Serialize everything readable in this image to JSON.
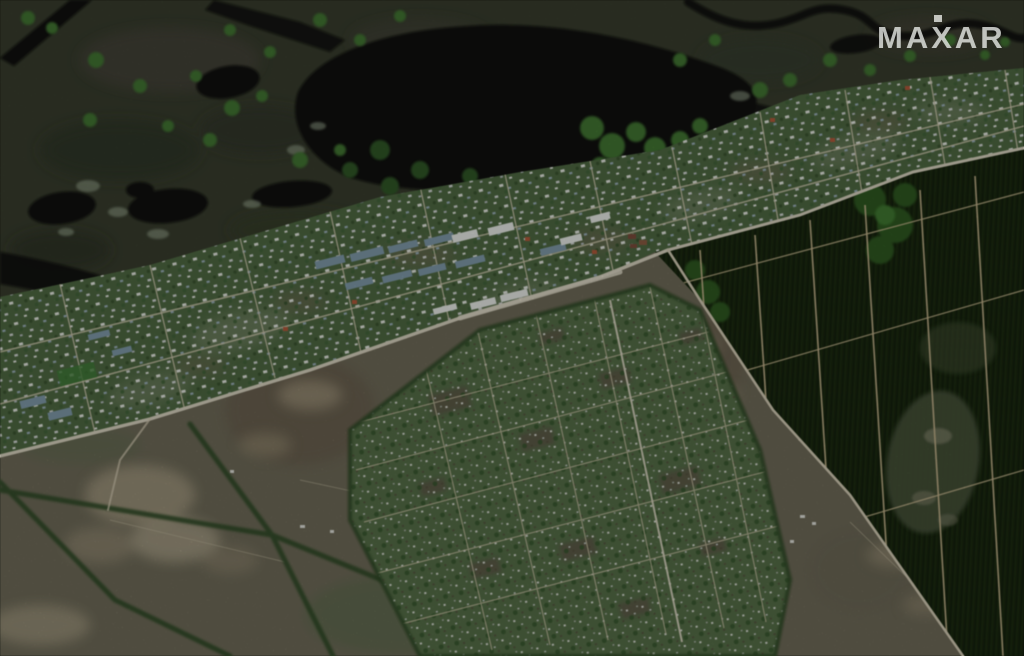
{
  "meta": {
    "type": "satellite-photo",
    "description": "Maxar satellite view: dark marsh wetland with black oxbow lake and winding channels across the top; a diagonal village strip of small houses, barns and light dirt streets; dense pine plantation forest with tan firebreak grid on the right; dacha allotment grid with tiny plots in the center-bottom; open grey-brown farm fields with pale patches and dark hedgerows in the bottom-left."
  },
  "watermark": {
    "text": "MAXAR",
    "color": "#eef0ec",
    "opacity": "0.78"
  },
  "palette": {
    "wetland": "#363b2d",
    "water": "#0a0d08",
    "village": "#4d6842",
    "forest": "#18260f",
    "field": "#6e6a59",
    "dacha": "#57704a",
    "road": "#dcd6c4",
    "street": "#cfc8b0",
    "path_light": "#cdc5aa",
    "hedge": "#2d4a26",
    "firebreak": "#c7b690",
    "tree": "#3f7433",
    "tree_dark": "#2f5626",
    "pale_field": "#a79c84",
    "barn_roof": "#7e99ab",
    "house_red": "#b2593a"
  }
}
